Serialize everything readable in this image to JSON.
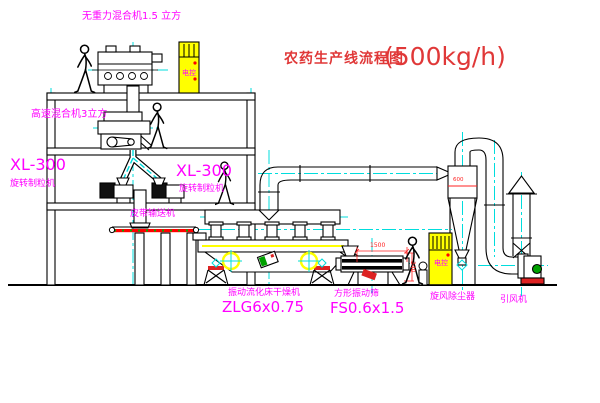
{
  "title": {
    "main": "农药生产线流程图",
    "capacity": "(500kg/h)"
  },
  "equipment_labels": {
    "gravity_mixer": "无重力混合机1.5 立方",
    "high_speed_mixer": "高速混合机3立方",
    "granulator_left_model": "XL-300",
    "granulator_left_name": "旋转制粒机",
    "granulator_right_model": "XL-300",
    "granulator_right_name": "旋转制粒机",
    "belt_conveyor": "皮带输送机",
    "dryer_name": "振动流化床干燥机",
    "dryer_model": "ZLG6x0.75",
    "sieve_name": "方形振动筛",
    "sieve_model": "FS0.6x1.5",
    "cyclone": "旋风除尘器",
    "induced_draft_fan": "引风机",
    "control_cabinet_top": "电控",
    "control_cabinet_right": "电控"
  },
  "dimensions": {
    "sieve_length": "1500",
    "sieve_height": "340",
    "cyclone_marking": "600"
  },
  "colors": {
    "line": "#000000",
    "centerline": "#00dddd",
    "label_magenta": "#ff00ff",
    "title_red": "#e03838",
    "dimension_red": "#ff2222",
    "cabinet_yellow": "#ffff00",
    "belt_red": "#ff0000",
    "accent_green": "#00a000"
  }
}
